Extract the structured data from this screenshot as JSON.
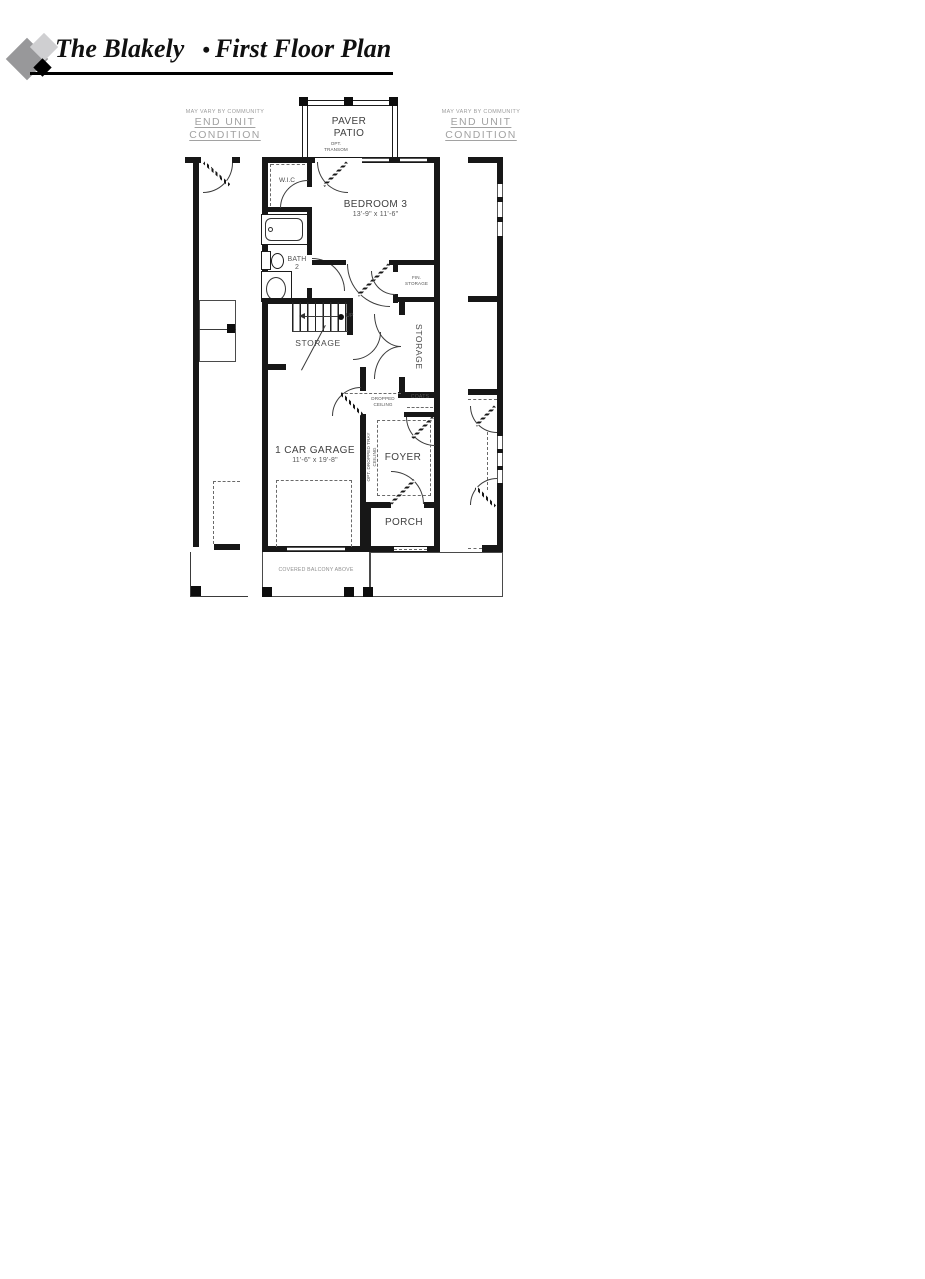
{
  "header": {
    "title": "The Blakely",
    "bullet": "•",
    "subtitle": "First Floor Plan"
  },
  "notes": {
    "left": {
      "small": "MAY VARY BY COMMUNITY",
      "line1": "END UNIT",
      "line2": "CONDITION"
    },
    "right": {
      "small": "MAY VARY BY COMMUNITY",
      "line1": "END UNIT",
      "line2": "CONDITION"
    }
  },
  "plan": {
    "paver_patio": {
      "line1": "PAVER",
      "line2": "PATIO"
    },
    "opt_transom": {
      "line1": "OPT.",
      "line2": "TRANSOM"
    },
    "wic": "W.I.C",
    "bedroom3": {
      "name": "BEDROOM 3",
      "dims": "13'-9\" x 11'-6\""
    },
    "bath2": {
      "line1": "BATH",
      "line2": "2"
    },
    "fin_storage": {
      "line1": "FIN.",
      "line2": "STORAGE"
    },
    "up": "UP",
    "storage_under_stairs": "STORAGE",
    "storage_closet": "STORAGE",
    "dropped_ceiling": {
      "line1": "DROPPED",
      "line2": "CEILING"
    },
    "coats": "COATS",
    "foyer": "FOYER",
    "opt_tray": "OPT. DROPPED TRAY CEILING",
    "garage": {
      "name": "1 CAR GARAGE",
      "dims": "11'-6\" x 19'-8\""
    },
    "porch": "PORCH",
    "covered_balcony": "COVERED BALCONY ABOVE"
  },
  "colors": {
    "wall": "#171717",
    "label": "#404040",
    "note": "#a2a2a2",
    "logo_gray": "#98989a",
    "logo_light": "#cfcfd1",
    "logo_black": "#000000"
  }
}
